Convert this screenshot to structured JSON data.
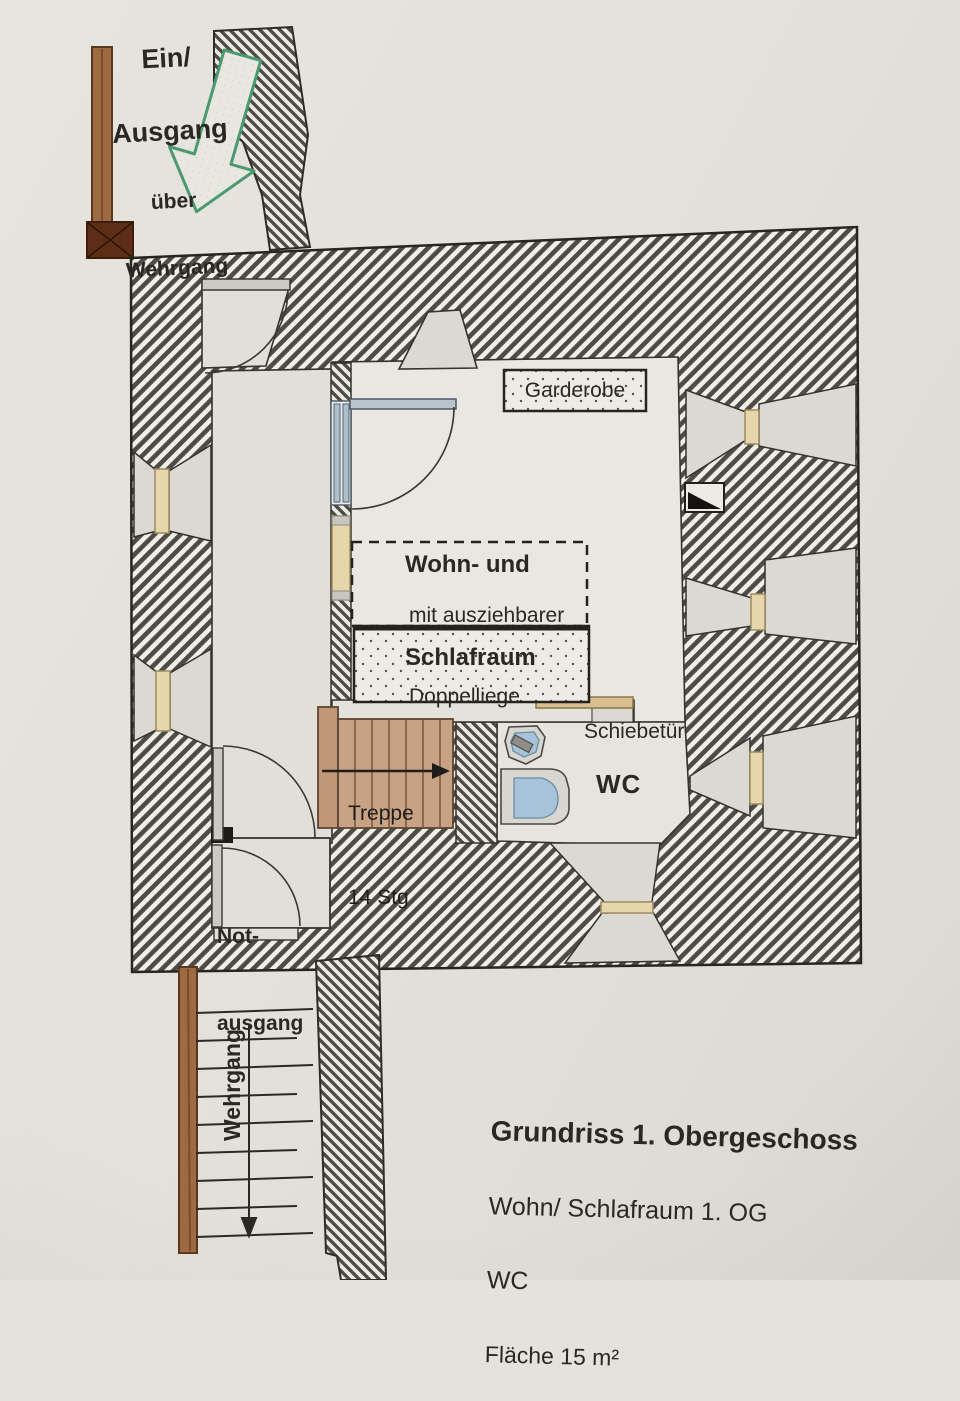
{
  "plan": {
    "entrance_note": {
      "line1": "Ein/",
      "line2": "Ausgang",
      "line3": "über",
      "line4": "Wehrgang"
    },
    "rooms": {
      "wardrobe": "Garderobe",
      "living_title1": "Wohn- und",
      "living_title2": "Schlafraum",
      "bed_note1": "mit ausziehbarer",
      "bed_note2": "Doppelliege",
      "sliding_door": "Schiebetür",
      "wc": "WC",
      "stairs1": "Treppe",
      "stairs2": "14 Stg",
      "emergency1": "Not-",
      "emergency2": "ausgang",
      "wehrgang": "Wehrgang"
    },
    "caption": {
      "title": "Grundriss 1. Obergeschoss",
      "subtitle1": "Wohn/ Schlafraum 1. OG",
      "subtitle2": "WC",
      "subtitle3": "Fläche 15 m²"
    },
    "colors": {
      "paper": "#e4e1db",
      "wall_stripe": "#4f4b46",
      "wall_bg": "#f0eee8",
      "wood_stairs": "#c8a284",
      "wood_beam": "#9e6a44",
      "window_slit": "#e7d6ab",
      "door_blue": "#b9c4cd",
      "fixture_blue": "#a7c3da",
      "arrow_green": "#4a9a6f"
    }
  }
}
